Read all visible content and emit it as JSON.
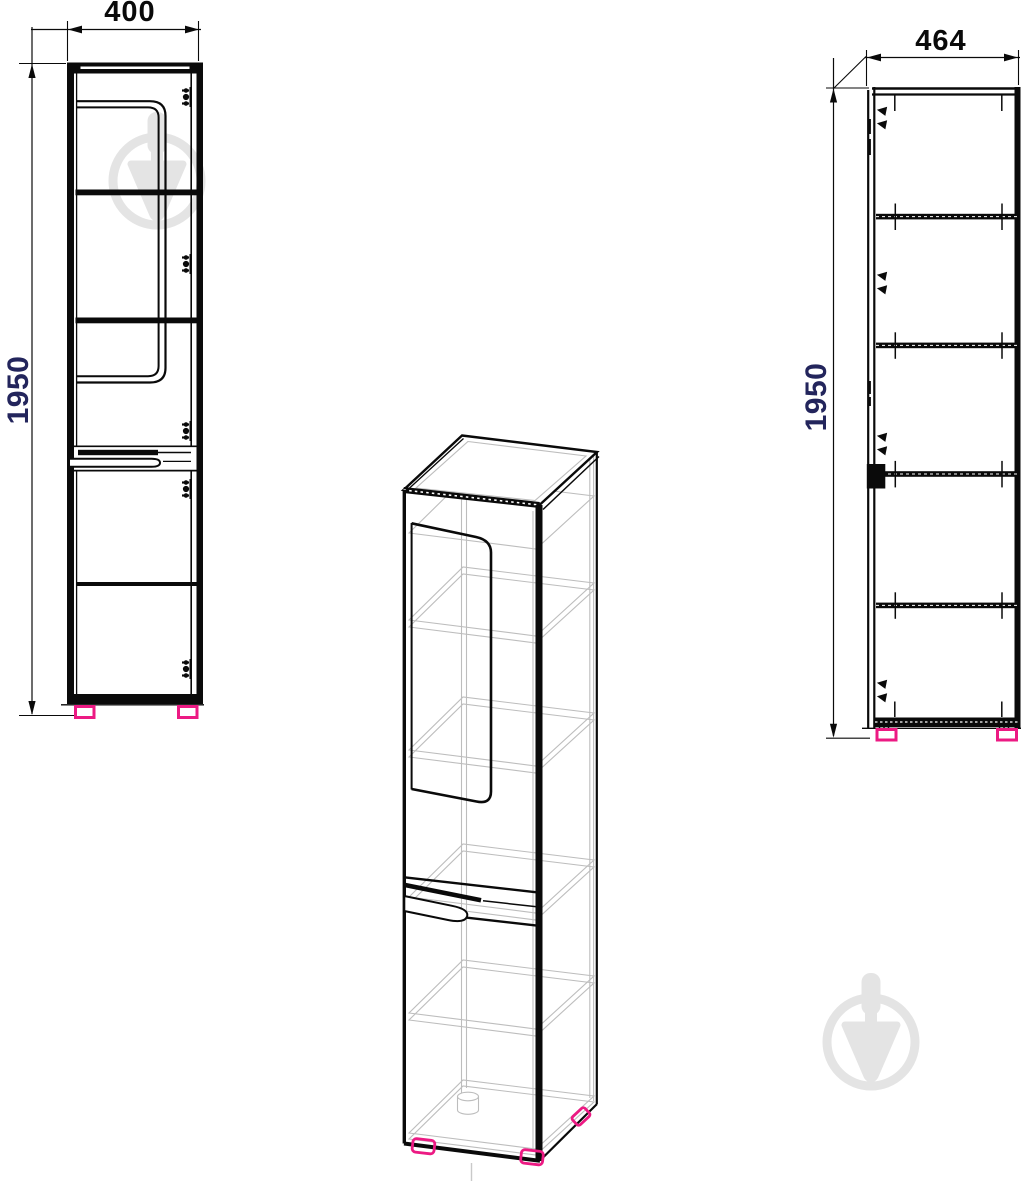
{
  "drawing": {
    "type": "furniture-three-view-technical-drawing",
    "front_view": {
      "width_label": "400",
      "height_label": "1950"
    },
    "side_view": {
      "width_label": "464",
      "height_label": "1950"
    },
    "colors": {
      "line_black": "#0a0a0a",
      "width_dimension_text": "#0a0a0a",
      "height_dimension_text": "#23255c",
      "feet_pink": "#ec1a83",
      "wireframe_gray": "#bdbdbd",
      "watermark_gray": "#e4e4e4"
    },
    "icons": {
      "watermark": "trowel-in-circle-watermark-icon"
    }
  }
}
